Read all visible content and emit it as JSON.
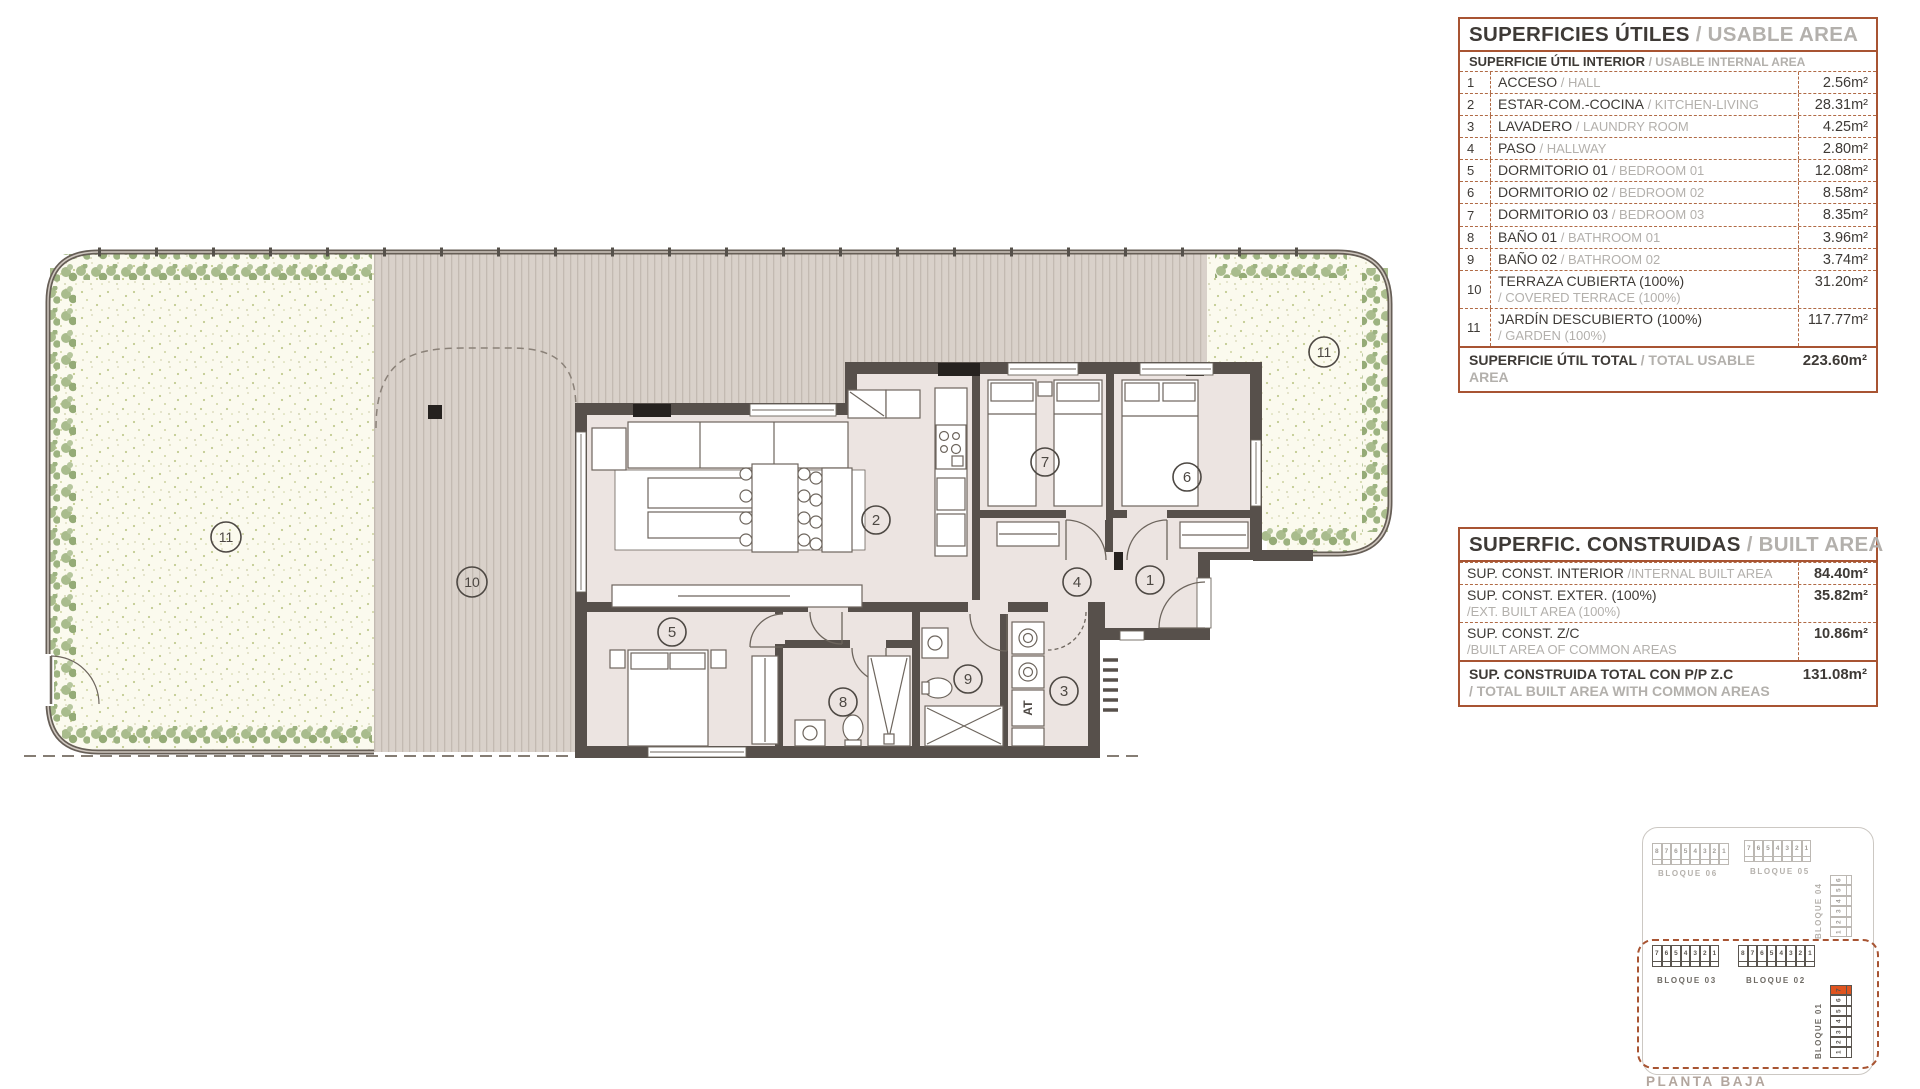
{
  "colors": {
    "accent": "#a85432",
    "dash": "#b06a45",
    "orange": "#e0541f",
    "wall": "#57504b",
    "floor": "#ece4e1",
    "terrace": "#d9d1ca",
    "garden": "#fbfaee",
    "plants": "#a3b888"
  },
  "usable_area_table": {
    "title_es": "SUPERFICIES ÚTILES",
    "title_en": "/ USABLE AREA",
    "subtitle_es": "SUPERFICIE ÚTIL INTERIOR",
    "subtitle_en": "/ USABLE INTERNAL AREA",
    "rows": [
      {
        "num": "1",
        "es": "ACCESO",
        "en": "/ HALL",
        "value": "2.56m²"
      },
      {
        "num": "2",
        "es": "ESTAR-COM.-COCINA",
        "en": "/ KITCHEN-LIVING",
        "value": "28.31m²"
      },
      {
        "num": "3",
        "es": "LAVADERO",
        "en": "/ LAUNDRY ROOM",
        "value": "4.25m²"
      },
      {
        "num": "4",
        "es": "PASO",
        "en": "/ HALLWAY",
        "value": "2.80m²"
      },
      {
        "num": "5",
        "es": "DORMITORIO 01",
        "en": "/ BEDROOM 01",
        "value": "12.08m²"
      },
      {
        "num": "6",
        "es": "DORMITORIO 02",
        "en": "/ BEDROOM 02",
        "value": "8.58m²"
      },
      {
        "num": "7",
        "es": "DORMITORIO 03",
        "en": "/ BEDROOM 03",
        "value": "8.35m²"
      },
      {
        "num": "8",
        "es": "BAÑO 01",
        "en": "/ BATHROOM 01",
        "value": "3.96m²"
      },
      {
        "num": "9",
        "es": "BAÑO 02",
        "en": "/ BATHROOM 02",
        "value": "3.74m²"
      },
      {
        "num": "10",
        "es": "TERRAZA CUBIERTA (100%)",
        "en": "/ COVERED TERRACE (100%)",
        "value": "31.20m²",
        "twoline": true
      },
      {
        "num": "11",
        "es": "JARDÍN DESCUBIERTO (100%)",
        "en": "/ GARDEN (100%)",
        "value": "117.77m²",
        "twoline": true
      }
    ],
    "total_es": "SUPERFICIE ÚTIL TOTAL",
    "total_en": "/ TOTAL USABLE AREA",
    "total_value": "223.60m²"
  },
  "built_area_table": {
    "title_es": "SUPERFIC. CONSTRUIDAS",
    "title_en": "/ BUILT AREA",
    "rows": [
      {
        "es": "SUP. CONST. INTERIOR",
        "en": "/INTERNAL BUILT AREA",
        "value": "84.40m²"
      },
      {
        "es": "SUP. CONST. EXTER. (100%)",
        "en": "/EXT. BUILT AREA (100%)",
        "value": "35.82m²",
        "twoline": true
      },
      {
        "es": "SUP. CONST. Z/C",
        "en": "/BUILT AREA OF COMMON AREAS",
        "value": "10.86m²",
        "twoline": true
      }
    ],
    "total_es": "SUP. CONSTRUIDA TOTAL CON P/P Z.C",
    "total_en": "/ TOTAL BUILT AREA WITH COMMON AREAS",
    "total_value": "131.08m²"
  },
  "floorplan": {
    "labels": {
      "n1": "1",
      "n2": "2",
      "n3": "3",
      "n4": "4",
      "n5": "5",
      "n6": "6",
      "n7": "7",
      "n8": "8",
      "n9": "9",
      "n10": "10",
      "n11": "11"
    },
    "at_label": "AT"
  },
  "site_plan": {
    "blocks": [
      {
        "label": "BLOQUE 06",
        "cells": [
          "8",
          "7",
          "6",
          "5",
          "4",
          "3",
          "2",
          "1"
        ]
      },
      {
        "label": "BLOQUE 05",
        "cells": [
          "7",
          "6",
          "5",
          "4",
          "3",
          "2",
          "1"
        ]
      },
      {
        "label": "BLOQUE 04",
        "cells": [
          "6",
          "5",
          "4",
          "3",
          "2",
          "1"
        ]
      },
      {
        "label": "BLOQUE 03",
        "cells": [
          "7",
          "6",
          "5",
          "4",
          "3",
          "2",
          "1"
        ]
      },
      {
        "label": "BLOQUE 02",
        "cells": [
          "8",
          "7",
          "6",
          "5",
          "4",
          "3",
          "2",
          "1"
        ]
      },
      {
        "label": "BLOQUE 01",
        "cells": [
          "7",
          "6",
          "5",
          "4",
          "3",
          "2",
          "1"
        ],
        "highlight": 0
      }
    ],
    "planta_label": "PLANTA BAJA"
  }
}
